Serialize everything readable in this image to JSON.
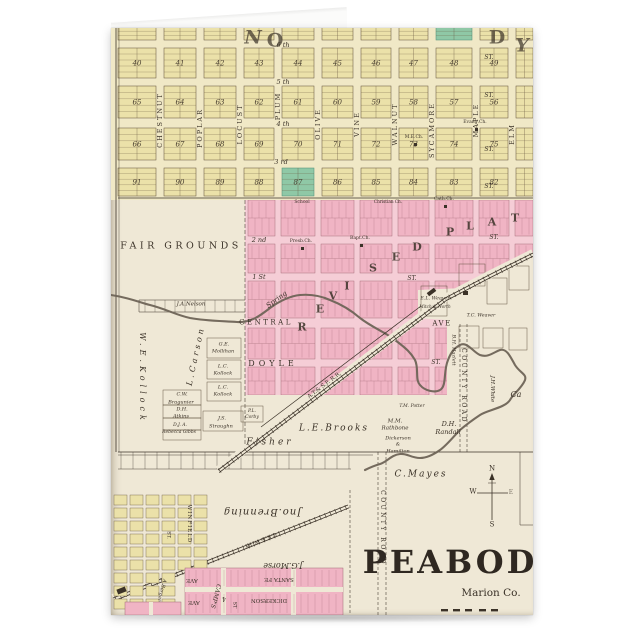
{
  "product": {
    "kind": "folded greeting card mockup",
    "surface": "antique plat map"
  },
  "colors": {
    "page_bg": "#ffffff",
    "paper": "#efe8d6",
    "yellow_block": "#ebe1a9",
    "yellow_bg": "#f0e8c6",
    "pink_block": "#f0b4c4",
    "pink_bg": "#f5cdd6",
    "green_block": "#8fc8a6",
    "ink": "#3b3228",
    "creek": "#6e6457"
  },
  "yellow_grid": {
    "x_bounds": [
      7,
      49,
      89,
      129,
      167,
      207,
      246,
      284,
      321,
      365,
      401,
      422
    ],
    "rows": [
      {
        "y": -10,
        "h": 22,
        "nums": [
          "",
          "",
          "",
          "",
          "",
          "",
          "",
          "",
          "",
          "",
          ""
        ]
      },
      {
        "y": 20,
        "h": 30,
        "nums": [
          "40",
          "41",
          "42",
          "43",
          "44",
          "45",
          "46",
          "47",
          "48",
          "49",
          ""
        ]
      },
      {
        "y": 58,
        "h": 32,
        "nums": [
          "65",
          "64",
          "63",
          "62",
          "61",
          "60",
          "59",
          "58",
          "57",
          "56",
          ""
        ]
      },
      {
        "y": 100,
        "h": 32,
        "nums": [
          "66",
          "67",
          "68",
          "69",
          "70",
          "71",
          "72",
          "73",
          "74",
          "75",
          ""
        ]
      },
      {
        "y": 140,
        "h": 28,
        "nums": [
          "91",
          "90",
          "89",
          "88",
          "87",
          "86",
          "85",
          "84",
          "83",
          "82",
          ""
        ]
      }
    ],
    "green": [
      [
        0,
        8
      ],
      [
        4,
        4
      ]
    ]
  },
  "pink_grid": {
    "cols": [
      134,
      167,
      207,
      246,
      284,
      321,
      365,
      401,
      422
    ],
    "rows": [
      [
        172,
        36
      ],
      [
        216,
        29
      ],
      [
        253,
        37
      ],
      [
        300,
        31
      ],
      [
        339,
        28
      ]
    ],
    "polygon": "134,172 422,172 422,228 352,260 307,262 307,290 336,292 336,367 134,367"
  },
  "labels": [
    {
      "t": "N",
      "x": 142,
      "y": 10,
      "fs": 19,
      "b": 1,
      "it": 1,
      "op": 0.7
    },
    {
      "t": "O",
      "x": 164,
      "y": 13,
      "fs": 19,
      "b": 1,
      "op": 0.7
    },
    {
      "t": "D",
      "x": 386,
      "y": 10,
      "fs": 19,
      "b": 1,
      "op": 0.7
    },
    {
      "t": "Y",
      "x": 411,
      "y": 18,
      "fs": 19,
      "b": 1,
      "it": 1,
      "op": 0.7
    },
    {
      "t": "CHESTNUT",
      "x": 49,
      "y": 92,
      "fs": 6.5,
      "ls": 2,
      "rot": -90
    },
    {
      "t": "POPLAR",
      "x": 89,
      "y": 100,
      "fs": 6.5,
      "ls": 2,
      "rot": -90
    },
    {
      "t": "LOCUST",
      "x": 129,
      "y": 96,
      "fs": 6.5,
      "ls": 2,
      "rot": -90
    },
    {
      "t": "PLUM",
      "x": 167,
      "y": 78,
      "fs": 6.5,
      "ls": 2,
      "rot": -90
    },
    {
      "t": "OLIVE",
      "x": 207,
      "y": 96,
      "fs": 6.5,
      "ls": 2,
      "rot": -90
    },
    {
      "t": "VINE",
      "x": 246,
      "y": 96,
      "fs": 6.5,
      "ls": 2,
      "rot": -90
    },
    {
      "t": "WALNUT",
      "x": 284,
      "y": 96,
      "fs": 6.5,
      "ls": 2,
      "rot": -90
    },
    {
      "t": "SYCAMORE",
      "x": 321,
      "y": 102,
      "fs": 6.5,
      "ls": 2,
      "rot": -90
    },
    {
      "t": "MAPLE",
      "x": 365,
      "y": 92,
      "fs": 6.5,
      "ls": 2,
      "rot": -90
    },
    {
      "t": "ELM",
      "x": 401,
      "y": 106,
      "fs": 6.5,
      "ls": 2,
      "rot": -90
    },
    {
      "t": "6 th",
      "x": 172,
      "y": 17,
      "fs": 6.5,
      "it": 1
    },
    {
      "t": "5 th",
      "x": 172,
      "y": 54,
      "fs": 6.5,
      "it": 1
    },
    {
      "t": "4 th",
      "x": 172,
      "y": 96,
      "fs": 6.5,
      "it": 1
    },
    {
      "t": "3 rd",
      "x": 170,
      "y": 134,
      "fs": 6.5,
      "it": 1
    },
    {
      "t": "2 nd",
      "x": 148,
      "y": 212,
      "fs": 6.5,
      "it": 1
    },
    {
      "t": "1 St",
      "x": 148,
      "y": 249,
      "fs": 6.5,
      "it": 1
    },
    {
      "t": "ST.",
      "x": 378,
      "y": 30,
      "fs": 6,
      "it": 1
    },
    {
      "t": "ST.",
      "x": 378,
      "y": 68,
      "fs": 6,
      "it": 1
    },
    {
      "t": "ST.",
      "x": 378,
      "y": 122,
      "fs": 6,
      "it": 1
    },
    {
      "t": "ST.",
      "x": 378,
      "y": 159,
      "fs": 6,
      "it": 1
    },
    {
      "t": "ST.",
      "x": 383,
      "y": 210,
      "fs": 6,
      "it": 1
    },
    {
      "t": "ST.",
      "x": 301,
      "y": 251,
      "fs": 6,
      "it": 1
    },
    {
      "t": "ST.",
      "x": 325,
      "y": 335,
      "fs": 6,
      "it": 1
    },
    {
      "t": "CENTRAL",
      "x": 155,
      "y": 295,
      "fs": 7,
      "ls": 2.5
    },
    {
      "t": "AVE",
      "x": 331,
      "y": 296,
      "fs": 7,
      "ls": 1.5
    },
    {
      "t": "R",
      "x": 191,
      "y": 299,
      "fs": 11,
      "b": 1,
      "op": 0.85
    },
    {
      "t": "E",
      "x": 209,
      "y": 281,
      "fs": 11,
      "b": 1,
      "op": 0.85
    },
    {
      "t": "V",
      "x": 222,
      "y": 268,
      "fs": 11,
      "b": 1,
      "op": 0.85
    },
    {
      "t": "I",
      "x": 236,
      "y": 258,
      "fs": 11,
      "b": 1,
      "op": 0.85
    },
    {
      "t": "S",
      "x": 262,
      "y": 240,
      "fs": 11,
      "b": 1,
      "op": 0.85
    },
    {
      "t": "E",
      "x": 285,
      "y": 229,
      "fs": 11,
      "b": 1,
      "op": 0.85
    },
    {
      "t": "D",
      "x": 306,
      "y": 219,
      "fs": 11,
      "b": 1,
      "op": 0.85
    },
    {
      "t": "P",
      "x": 339,
      "y": 204,
      "fs": 11,
      "b": 1,
      "op": 0.85
    },
    {
      "t": "L",
      "x": 359,
      "y": 198,
      "fs": 11,
      "b": 1,
      "op": 0.85
    },
    {
      "t": "A",
      "x": 381,
      "y": 194,
      "fs": 11,
      "b": 1,
      "op": 0.85
    },
    {
      "t": "T",
      "x": 404,
      "y": 190,
      "fs": 11,
      "b": 1,
      "op": 0.85
    },
    {
      "t": "FAIR GROUNDS",
      "x": 70,
      "y": 218,
      "fs": 9.5,
      "ls": 3.5
    },
    {
      "t": "J.A.Nelson",
      "x": 80,
      "y": 277,
      "fs": 5.5,
      "it": 1
    },
    {
      "t": "W.E.Kollock",
      "x": 31,
      "y": 350,
      "fs": 8,
      "ls": 4,
      "it": 1,
      "rot": 90
    },
    {
      "t": "L.Carson",
      "x": 85,
      "y": 328,
      "fs": 8,
      "ls": 3,
      "it": 1,
      "rot": -78
    },
    {
      "t": "G.E.",
      "x": 113,
      "y": 317,
      "fs": 5,
      "it": 1
    },
    {
      "t": "Mollihan",
      "x": 112,
      "y": 324,
      "fs": 5,
      "it": 1
    },
    {
      "t": "L.C.",
      "x": 112,
      "y": 339,
      "fs": 5,
      "it": 1
    },
    {
      "t": "Kollock",
      "x": 112,
      "y": 346,
      "fs": 5,
      "it": 1
    },
    {
      "t": "L.C.",
      "x": 112,
      "y": 360,
      "fs": 5,
      "it": 1
    },
    {
      "t": "Kollock",
      "x": 112,
      "y": 367,
      "fs": 5,
      "it": 1
    },
    {
      "t": "C.W.",
      "x": 71,
      "y": 367,
      "fs": 5,
      "it": 1
    },
    {
      "t": "Bragunier",
      "x": 70,
      "y": 375,
      "fs": 5,
      "it": 1
    },
    {
      "t": "D.H.",
      "x": 71,
      "y": 382,
      "fs": 5,
      "it": 1
    },
    {
      "t": "Atkins",
      "x": 70,
      "y": 389,
      "fs": 5,
      "it": 1
    },
    {
      "t": "D.J. A.",
      "x": 69,
      "y": 398,
      "fs": 4.5,
      "it": 1
    },
    {
      "t": "Rebecca Gibbs",
      "x": 68,
      "y": 405,
      "fs": 4.5,
      "it": 1
    },
    {
      "t": "J.S.",
      "x": 111,
      "y": 391,
      "fs": 5,
      "it": 1
    },
    {
      "t": "Straughn",
      "x": 110,
      "y": 399,
      "fs": 5,
      "it": 1
    },
    {
      "t": "P.L.",
      "x": 141,
      "y": 384,
      "fs": 4.5,
      "it": 1
    },
    {
      "t": "Corby",
      "x": 141,
      "y": 390,
      "fs": 4.5,
      "it": 1
    },
    {
      "t": "Fisher",
      "x": 159,
      "y": 415,
      "fs": 9,
      "ls": 3,
      "it": 1
    },
    {
      "t": "L.E.Brooks",
      "x": 223,
      "y": 401,
      "fs": 9,
      "ls": 2,
      "it": 1
    },
    {
      "t": "M.M.",
      "x": 284,
      "y": 394,
      "fs": 5.5,
      "it": 1
    },
    {
      "t": "Rathbone",
      "x": 284,
      "y": 401,
      "fs": 5.5,
      "it": 1
    },
    {
      "t": "Dickerson",
      "x": 287,
      "y": 411,
      "fs": 5,
      "it": 1
    },
    {
      "t": "&",
      "x": 287,
      "y": 417,
      "fs": 5,
      "it": 1
    },
    {
      "t": "Hamilton",
      "x": 287,
      "y": 424,
      "fs": 5,
      "it": 1
    },
    {
      "t": "D.H.",
      "x": 338,
      "y": 396,
      "fs": 6.5,
      "it": 1
    },
    {
      "t": "Randall",
      "x": 337,
      "y": 404,
      "fs": 6.5,
      "it": 1
    },
    {
      "t": "T.M. Potter",
      "x": 301,
      "y": 379,
      "fs": 4.5,
      "it": 1
    },
    {
      "t": "E.L. Weaver",
      "x": 324,
      "y": 272,
      "fs": 4.8,
      "it": 1
    },
    {
      "t": "Mitch & North",
      "x": 324,
      "y": 279,
      "fs": 4.2,
      "it": 1
    },
    {
      "t": "T.C. Weaver",
      "x": 370,
      "y": 289,
      "fs": 4.8,
      "it": 1
    },
    {
      "t": "B.H. Hazlett",
      "x": 342,
      "y": 322,
      "fs": 5,
      "it": 1,
      "rot": 90
    },
    {
      "t": "COUNTY ROAD",
      "x": 352,
      "y": 358,
      "fs": 6,
      "ls": 2.5,
      "rot": 90
    },
    {
      "t": "J.H.White",
      "x": 380,
      "y": 361,
      "fs": 5.5,
      "it": 1,
      "rot": 90
    },
    {
      "t": "Ca",
      "x": 405,
      "y": 367,
      "fs": 8,
      "it": 1
    },
    {
      "t": "COUNTY ROAD",
      "x": 271,
      "y": 500,
      "fs": 6,
      "ls": 2.5,
      "rot": 90
    },
    {
      "t": "C.Mayes",
      "x": 310,
      "y": 447,
      "fs": 9,
      "ls": 2,
      "it": 1
    },
    {
      "t": "Spring",
      "x": 166,
      "y": 272,
      "fs": 7,
      "it": 1,
      "rot": -36
    },
    {
      "t": "DOYLE",
      "x": 162,
      "y": 336,
      "fs": 8,
      "ls": 4
    },
    {
      "t": "A.T.& S.F. R.R.",
      "x": 214,
      "y": 358,
      "fs": 5.5,
      "rot": -37
    },
    {
      "t": "M.E.Ch.",
      "x": 303,
      "y": 110,
      "fs": 4.5
    },
    {
      "t": "Evang.Ch.",
      "x": 364,
      "y": 95,
      "fs": 4.5
    },
    {
      "t": "School",
      "x": 191,
      "y": 175,
      "fs": 4.5
    },
    {
      "t": "Presb.Ch.",
      "x": 190,
      "y": 214,
      "fs": 4.5
    },
    {
      "t": "Bapt.Ch.",
      "x": 249,
      "y": 211,
      "fs": 4.5
    },
    {
      "t": "Christian Ch.",
      "x": 277,
      "y": 174,
      "fs": 4.2
    },
    {
      "t": "Cath.Ch.",
      "x": 333,
      "y": 172,
      "fs": 4.5
    },
    {
      "t": "N",
      "x": 381,
      "y": 441,
      "fs": 7
    },
    {
      "t": "W",
      "x": 362,
      "y": 464,
      "fs": 7
    },
    {
      "t": "E",
      "x": 400,
      "y": 465,
      "fs": 6,
      "op": 0.6
    },
    {
      "t": "S",
      "x": 381,
      "y": 497,
      "fs": 7
    },
    {
      "t": "PEABODY",
      "x": 352,
      "y": 534,
      "fs": 32,
      "b": 1,
      "ls": 3,
      "col": "#2f2821"
    },
    {
      "t": "Marion Co.",
      "x": 380,
      "y": 565,
      "fs": 10.5
    },
    {
      "t": "Jno.Brenning",
      "x": 151,
      "y": 483,
      "fs": 10,
      "it": 1,
      "ls": 1,
      "rot": 180
    },
    {
      "t": "J.G.Morse",
      "x": 172,
      "y": 537,
      "fs": 8,
      "it": 1,
      "rot": 180
    },
    {
      "t": "C.K.& W. RY",
      "x": 149,
      "y": 511,
      "fs": 5.5,
      "rot": 158
    },
    {
      "t": "SANTA FE",
      "x": 168,
      "y": 550,
      "fs": 5.5,
      "rot": 180
    },
    {
      "t": "AVE",
      "x": 81,
      "y": 551,
      "fs": 5.5,
      "rot": 180
    },
    {
      "t": "DICKERSON",
      "x": 158,
      "y": 571,
      "fs": 5.5,
      "rot": 180
    },
    {
      "t": "AVE",
      "x": 83,
      "y": 573,
      "fs": 5.5,
      "rot": 180
    },
    {
      "t": "CAMP'S",
      "x": 104,
      "y": 568,
      "fs": 6,
      "it": 1,
      "rot": 105
    },
    {
      "t": "4",
      "x": 113,
      "y": 570,
      "fs": 6,
      "rot": 180
    },
    {
      "t": "ST",
      "x": 123,
      "y": 577,
      "fs": 5,
      "rot": 90
    },
    {
      "t": "WINFIELD",
      "x": 77,
      "y": 496,
      "fs": 5.5,
      "ls": 1,
      "rot": 90
    },
    {
      "t": "A.Berger",
      "x": 50,
      "y": 562,
      "fs": 5,
      "it": 1,
      "rot": 105
    },
    {
      "t": "ST.",
      "x": 57,
      "y": 507,
      "fs": 5,
      "rot": 90
    }
  ],
  "markers": [
    {
      "name": "church-marker",
      "x": 303,
      "y": 115,
      "w": 3,
      "h": 3
    },
    {
      "name": "church-marker",
      "x": 190,
      "y": 219,
      "w": 3,
      "h": 3
    },
    {
      "name": "church-marker",
      "x": 249,
      "y": 216,
      "w": 3,
      "h": 3
    },
    {
      "name": "church-marker",
      "x": 333,
      "y": 177,
      "w": 3,
      "h": 3
    },
    {
      "name": "church-marker",
      "x": 364,
      "y": 100,
      "w": 3,
      "h": 3
    },
    {
      "name": "depot-marker",
      "x": 316,
      "y": 262,
      "w": 9,
      "h": 4,
      "rot": -37
    },
    {
      "name": "building-marker",
      "x": 352,
      "y": 263,
      "w": 5,
      "h": 4
    },
    {
      "name": "train-marker",
      "x": 6,
      "y": 560,
      "w": 9,
      "h": 5,
      "rot": -21
    }
  ]
}
